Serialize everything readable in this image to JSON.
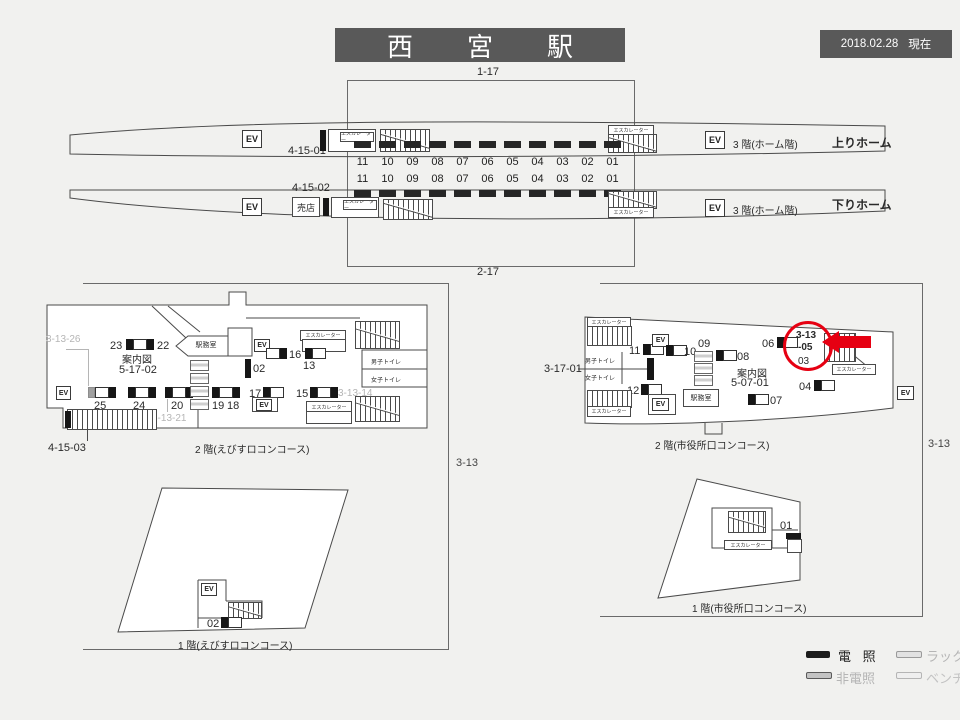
{
  "header": {
    "title": "西　宮　駅",
    "date": "2018.02.28",
    "status": "現在"
  },
  "common": {
    "ev": "EV",
    "escalator": "エスカレーター"
  },
  "platform_area": {
    "zone_top_label": "1-17",
    "zone_bottom_label": "2-17",
    "ad_numbers": [
      "11",
      "10",
      "09",
      "08",
      "07",
      "06",
      "05",
      "04",
      "03",
      "02",
      "01"
    ],
    "up_platform": {
      "code": "4-15-01",
      "floor_label": "3 階(ホーム階)",
      "name": "上りホーム"
    },
    "down_platform": {
      "code": "4-15-02",
      "kiosk": "売店",
      "floor_label": "3 階(ホーム階)",
      "name": "下りホーム"
    }
  },
  "ebisu_2f": {
    "caption": "2 階(えびすロコンコース)",
    "office": "駅務室",
    "info_board": "案内図",
    "info_code": "5-17-02",
    "mens_toilet": "男子トイレ",
    "womens_toilet": "女子トイレ",
    "codes": {
      "c26": "3-13-26",
      "c21": "3-13-21",
      "c14": "3-13-14",
      "c03": "4-15-03"
    },
    "positions": {
      "p23": "23",
      "p22": "22",
      "p25": "25",
      "p24": "24",
      "p20": "20",
      "p19": "19",
      "p18": "18",
      "p17": "17",
      "p16": "16",
      "p15": "15",
      "p13": "13",
      "p02": "02"
    },
    "zone_label": "3-13"
  },
  "ebisu_1f": {
    "caption": "1 階(えびすロコンコース)",
    "p02": "02"
  },
  "shiyakusho_2f": {
    "caption": "2 階(市役所口コンコース)",
    "office": "駅務室",
    "info_board": "案内図",
    "info_code": "5-07-01",
    "mens_toilet": "男子トイレ",
    "womens_toilet": "女子トイレ",
    "code_17": "3-17-01",
    "highlight": {
      "line1": "3-13",
      "line2": "-05"
    },
    "positions": {
      "p11": "11",
      "p10": "10",
      "p09": "09",
      "p08": "08",
      "p07": "07",
      "p06": "06",
      "p04": "04",
      "p03": "03",
      "p12": "12"
    },
    "zone_label": "3-13"
  },
  "shiyakusho_1f": {
    "caption": "1 階(市役所口コンコース)",
    "p01": "01"
  },
  "legend": {
    "items": [
      {
        "label": "電 照",
        "type": "lit"
      },
      {
        "label": "ラック",
        "type": "rack"
      },
      {
        "label": "非電照",
        "type": "non-lit"
      },
      {
        "label": "ベンチ",
        "type": "bench"
      }
    ]
  },
  "colors": {
    "header_bg": "#595959",
    "accent_red": "#e60012",
    "line": "#4a4a4a",
    "gray_text": "#b5b5b5"
  }
}
